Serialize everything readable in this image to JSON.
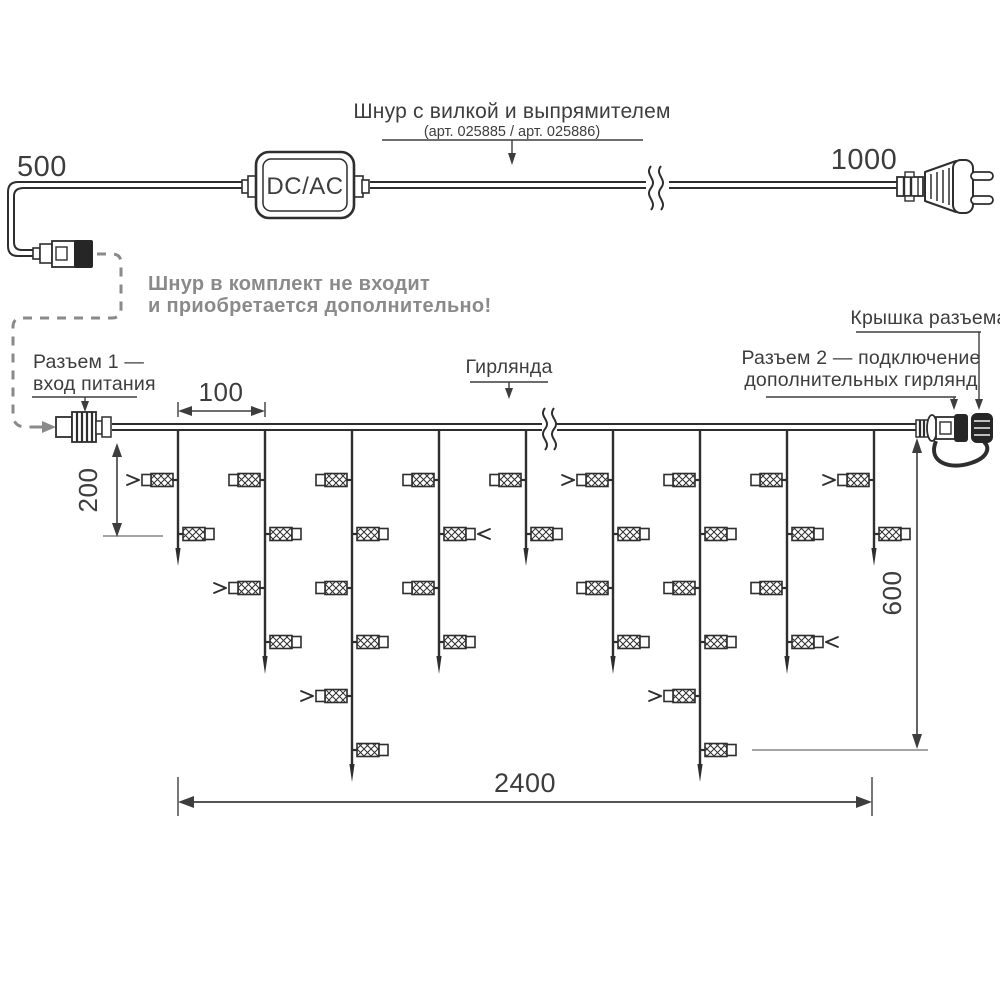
{
  "diagram": {
    "type": "garland-installation-scheme",
    "units": "mm"
  },
  "labels": {
    "cord_title": "Шнур с вилкой и выпрямителем",
    "cord_subtitle": "(арт. 025885 / арт. 025886)",
    "cord_length_left": "500",
    "cord_length_right": "1000",
    "adapter": "DC/AC",
    "note_line1": "Шнур в комплект не входит",
    "note_line2": "и приобретается дополнительно!",
    "connector1_line1": "Разъем 1 —",
    "connector1_line2": "вход питания",
    "garland": "Гирлянда",
    "connector2_line1": "Разъем 2 — подключение",
    "connector2_line2": "дополнительных гирлянд",
    "cap": "Крышка разъема"
  },
  "dimensions": {
    "drop_spacing": "100",
    "first_drop_length": "200",
    "curtain_height": "600",
    "garland_length": "2400"
  },
  "colors": {
    "ink": "#2e2e2e",
    "text": "#3d3d3d",
    "muted": "#8a8a8a"
  },
  "garland": {
    "wire_y": 427,
    "wire_x1": 112,
    "wire_x2": 918,
    "break_x": 549,
    "led_rows_y": [
      480,
      534,
      588,
      642,
      696,
      750
    ],
    "drops": [
      {
        "x": 178,
        "leds": 2,
        "arrow_row": 0
      },
      {
        "x": 265,
        "leds": 4,
        "arrow_row": 2
      },
      {
        "x": 352,
        "leds": 6,
        "arrow_row": 4
      },
      {
        "x": 439,
        "leds": 4,
        "arrow_row": 1
      },
      {
        "x": 526,
        "leds": 2,
        "arrow_row": null
      },
      {
        "x": 613,
        "leds": 4,
        "arrow_row": 0
      },
      {
        "x": 700,
        "leds": 6,
        "arrow_row": 4
      },
      {
        "x": 787,
        "leds": 4,
        "arrow_row": 3
      },
      {
        "x": 874,
        "leds": 2,
        "arrow_row": 0
      }
    ]
  }
}
